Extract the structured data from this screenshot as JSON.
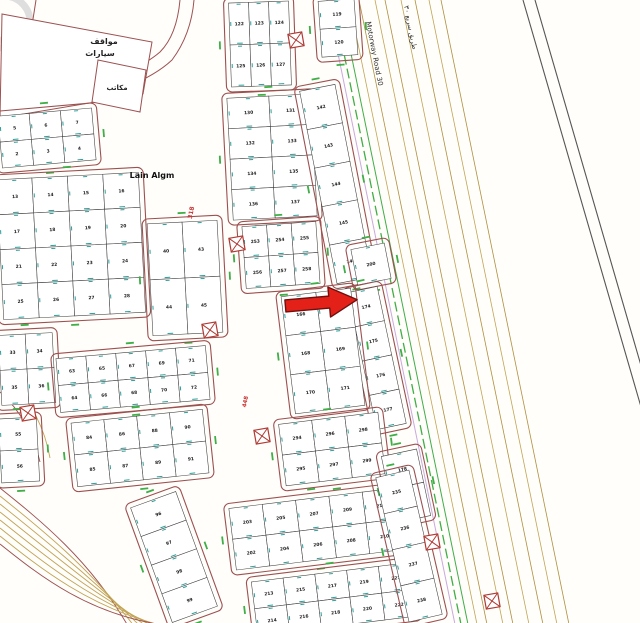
{
  "canvas": {
    "w": 640,
    "h": 623
  },
  "colors": {
    "bg": "#fffefb",
    "maroon": "#9c5050",
    "tan": "#c2a455",
    "tan2": "#b08f3e",
    "green": "#3fae46",
    "teal": "#2f9e99",
    "lavender": "#c9a9e0",
    "roadblack": "#555555",
    "red_label": "#c83232",
    "plotline": "#3c3c3c",
    "number_ink": "#1c1c1c",
    "watermark": "#dedede",
    "arrow_fill": "#e32119",
    "arrow_stroke": "#70100e",
    "utility": "#b03a34"
  },
  "arrow": {
    "x": 284,
    "y": 290,
    "rot": -5,
    "points": "0,10 44,10 44,1 72,16 44,31 44,22 0,22",
    "target_plot": "174"
  },
  "motorway": {
    "x0": 333,
    "slope": 0.205,
    "green_offsets": [
      0,
      7
    ],
    "lavender_offset": -6,
    "tan_offsets": [
      16,
      26,
      42,
      52,
      68,
      82,
      96,
      108
    ],
    "black_road": {
      "x0": 523,
      "slope": 0.29,
      "gap": 12
    }
  },
  "diag_lanes": {
    "count": 8,
    "y0": 488,
    "gap": 8
  },
  "extra_roads": [
    {
      "d": "M0,102 C70,92 130,78 160,52 C172,40 178,22 180,0",
      "c": "maroon",
      "w": 1
    },
    {
      "d": "M0,116 C74,106 140,90 172,60 C184,44 192,24 194,0",
      "c": "maroon",
      "w": 1
    },
    {
      "d": "M36,0 C30,40 22,82 10,122",
      "c": "maroon",
      "w": 1
    },
    {
      "d": "M2,372 C28,396 44,424 50,458",
      "c": "tan",
      "w": 0.9
    },
    {
      "d": "M0,392 C22,412 34,436 40,462",
      "c": "maroon",
      "w": 0.9
    }
  ],
  "watermark_circles": [
    {
      "cx": 4,
      "cy": 22,
      "r": 26
    },
    {
      "cx": 4,
      "cy": 66,
      "r": 26
    }
  ],
  "parcels": [
    {
      "name": "parking-parcel",
      "points": "2,14 152,42 143,94 0,118"
    },
    {
      "name": "office-parcel",
      "points": "98,60 146,70 140,112 92,102"
    }
  ],
  "labels": [
    {
      "text": "مواقف",
      "x": 104,
      "y": 44,
      "size": 8,
      "rot": 0,
      "color": "#222222",
      "bold": true,
      "anchor": "middle"
    },
    {
      "text": "سيارات",
      "x": 100,
      "y": 56,
      "size": 8,
      "rot": 0,
      "color": "#222222",
      "bold": true,
      "anchor": "middle"
    },
    {
      "text": "مكاتب",
      "x": 117,
      "y": 90,
      "size": 7,
      "rot": 0,
      "color": "#222222",
      "bold": true,
      "anchor": "middle"
    },
    {
      "text": "Lain Algm",
      "x": 152,
      "y": 178,
      "size": 8,
      "rot": 0,
      "color": "#111111",
      "bold": true,
      "anchor": "middle"
    },
    {
      "text": "Motorway Road 30",
      "x": 366,
      "y": 22,
      "size": 7,
      "rot": 79,
      "color": "#333333",
      "bold": false,
      "anchor": "start"
    },
    {
      "text": "طريق سريع ٣٠",
      "x": 404,
      "y": 6,
      "size": 7,
      "rot": 79,
      "color": "#333333",
      "bold": false,
      "anchor": "start"
    },
    {
      "text": "318",
      "x": 193,
      "y": 213,
      "size": 6,
      "rot": -79,
      "color": "#c83232",
      "bold": true,
      "anchor": "middle"
    },
    {
      "text": "448",
      "x": 247,
      "y": 402,
      "size": 5.5,
      "rot": -79,
      "color": "#c83232",
      "bold": true,
      "anchor": "middle"
    }
  ],
  "utilities": [
    {
      "x": 296,
      "y": 40
    },
    {
      "x": 237,
      "y": 244
    },
    {
      "x": 210,
      "y": 330
    },
    {
      "x": 28,
      "y": 413
    },
    {
      "x": 262,
      "y": 436
    },
    {
      "x": 432,
      "y": 542
    },
    {
      "x": 492,
      "y": 601
    }
  ],
  "blocks": [
    {
      "id": "tl-a",
      "x": 0,
      "y": 112,
      "w": 94,
      "h": 52,
      "rot": -5,
      "rows": 2,
      "cols": 3,
      "nums": [
        "5",
        "6",
        "7",
        "2",
        "3",
        "4"
      ]
    },
    {
      "id": "tl-big",
      "x": 0,
      "y": 176,
      "w": 142,
      "h": 140,
      "rot": -3,
      "rows": 4,
      "cols": 4,
      "nums": [
        "13",
        "14",
        "15",
        "16",
        "17",
        "18",
        "19",
        "20",
        "21",
        "22",
        "23",
        "24",
        "25",
        "26",
        "27",
        "28"
      ]
    },
    {
      "id": "tl-small",
      "x": 0,
      "y": 334,
      "w": 54,
      "h": 70,
      "rot": -3,
      "rows": 2,
      "cols": 2,
      "nums": [
        "33",
        "34",
        "35",
        "36"
      ]
    },
    {
      "id": "strip-40",
      "x": 150,
      "y": 222,
      "w": 70,
      "h": 112,
      "rot": -3,
      "rows": 2,
      "cols": 2,
      "nums": [
        "40",
        "43",
        "44",
        "45"
      ]
    },
    {
      "id": "top-e",
      "x": 230,
      "y": 2,
      "w": 60,
      "h": 84,
      "rot": -2,
      "rows": 2,
      "cols": 3,
      "nums": [
        "122",
        "123",
        "124",
        "125",
        "126",
        "127"
      ]
    },
    {
      "id": "top-e2",
      "x": 320,
      "y": 0,
      "w": 36,
      "h": 56,
      "rot": -4,
      "rows": 2,
      "cols": 1,
      "nums": [
        "119",
        "120"
      ]
    },
    {
      "id": "mid-f",
      "x": 230,
      "y": 96,
      "w": 84,
      "h": 122,
      "rot": -3,
      "rows": 4,
      "cols": 2,
      "nums": [
        "130",
        "131",
        "132",
        "133",
        "134",
        "135",
        "136",
        "137"
      ]
    },
    {
      "id": "mid-253",
      "x": 244,
      "y": 224,
      "w": 74,
      "h": 62,
      "rot": -4,
      "rows": 2,
      "cols": 3,
      "nums": [
        "253",
        "254",
        "255",
        "256",
        "257",
        "258"
      ]
    },
    {
      "id": "col-g",
      "x": 318,
      "y": 86,
      "w": 36,
      "h": 196,
      "rot": -11,
      "rows": 5,
      "cols": 1,
      "nums": [
        "142",
        "143",
        "144",
        "145",
        "146"
      ]
    },
    {
      "id": "p200",
      "x": 354,
      "y": 246,
      "w": 34,
      "h": 36,
      "rot": -11,
      "rows": 1,
      "cols": 1,
      "nums": [
        "200"
      ]
    },
    {
      "id": "col-h",
      "x": 362,
      "y": 288,
      "w": 30,
      "h": 140,
      "rot": -12,
      "rows": 4,
      "cols": 1,
      "nums": [
        "174",
        "175",
        "176",
        "177"
      ]
    },
    {
      "id": "mid-h",
      "x": 288,
      "y": 292,
      "w": 70,
      "h": 118,
      "rot": -7,
      "rows": 3,
      "cols": 2,
      "nums": [
        "166",
        "167",
        "168",
        "169",
        "170",
        "171"
      ]
    },
    {
      "id": "bl-64",
      "x": 58,
      "y": 352,
      "w": 150,
      "h": 54,
      "rot": -5,
      "rows": 2,
      "cols": 5,
      "nums": [
        "63",
        "65",
        "67",
        "69",
        "71",
        "64",
        "66",
        "68",
        "70",
        "72"
      ]
    },
    {
      "id": "bl-84",
      "x": 74,
      "y": 416,
      "w": 132,
      "h": 64,
      "rot": -6,
      "rows": 2,
      "cols": 4,
      "nums": [
        "84",
        "86",
        "88",
        "90",
        "85",
        "87",
        "89",
        "91"
      ]
    },
    {
      "id": "col-left-bottom",
      "x": 0,
      "y": 418,
      "w": 38,
      "h": 64,
      "rot": -3,
      "rows": 2,
      "cols": 1,
      "nums": [
        "55",
        "56"
      ]
    },
    {
      "id": "diag-96",
      "x": 150,
      "y": 496,
      "w": 48,
      "h": 122,
      "rot": -20,
      "rows": 4,
      "cols": 1,
      "nums": [
        "96",
        "97",
        "98",
        "99"
      ]
    },
    {
      "id": "bc1",
      "x": 282,
      "y": 418,
      "w": 100,
      "h": 62,
      "rot": -7,
      "rows": 2,
      "cols": 3,
      "nums": [
        "294",
        "296",
        "298",
        "295",
        "297",
        "299"
      ]
    },
    {
      "id": "bc2",
      "x": 232,
      "y": 498,
      "w": 168,
      "h": 62,
      "rot": -7,
      "rows": 2,
      "cols": 5,
      "nums": [
        "203",
        "205",
        "207",
        "209",
        "211",
        "202",
        "204",
        "206",
        "208",
        "210"
      ]
    },
    {
      "id": "bc3",
      "x": 254,
      "y": 572,
      "w": 160,
      "h": 54,
      "rot": -7,
      "rows": 2,
      "cols": 5,
      "nums": [
        "213",
        "215",
        "217",
        "219",
        "221",
        "214",
        "216",
        "218",
        "220",
        "222"
      ]
    },
    {
      "id": "col-178",
      "x": 388,
      "y": 452,
      "w": 36,
      "h": 68,
      "rot": -12,
      "rows": 2,
      "cols": 1,
      "nums": [
        "178",
        "179"
      ]
    },
    {
      "id": "col-235",
      "x": 392,
      "y": 472,
      "w": 34,
      "h": 148,
      "rot": -13,
      "rows": 4,
      "cols": 1,
      "nums": [
        "235",
        "236",
        "237",
        "238"
      ]
    }
  ]
}
